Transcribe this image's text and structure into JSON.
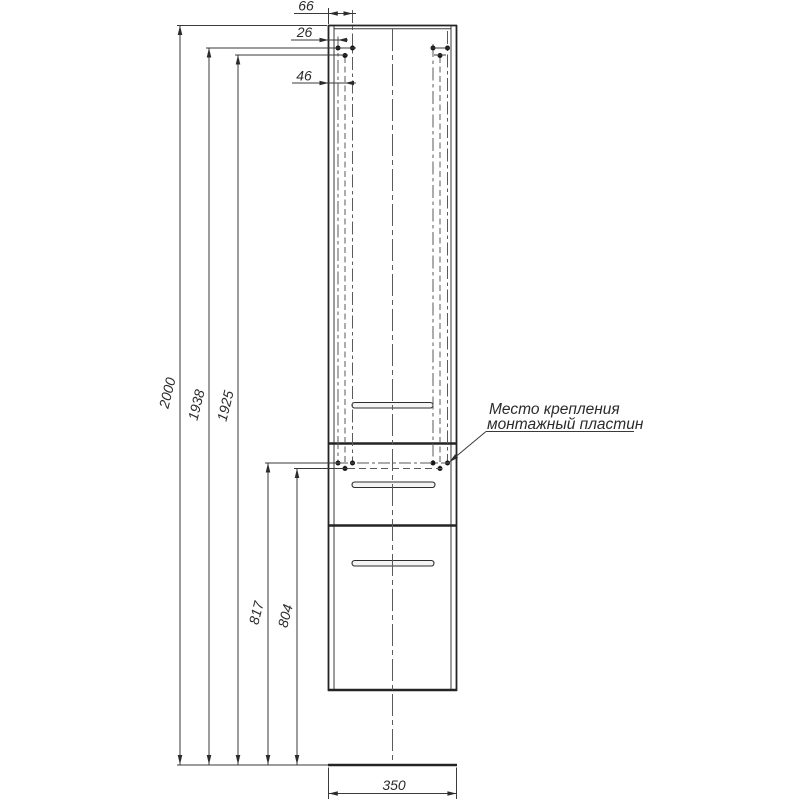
{
  "dimensions": {
    "top": [
      {
        "name": "hole-offset-outer",
        "label": "66"
      },
      {
        "name": "hole-offset-inner",
        "label": "26"
      },
      {
        "name": "hole-offset-middle",
        "label": "46"
      }
    ],
    "left": [
      {
        "name": "overall-height",
        "label": "2000"
      },
      {
        "name": "top-hole-outer-height",
        "label": "1938"
      },
      {
        "name": "top-hole-middle-height",
        "label": "1925"
      },
      {
        "name": "plate-hole-outer-height",
        "label": "817"
      },
      {
        "name": "plate-hole-middle-height",
        "label": "804"
      }
    ],
    "bottom": {
      "name": "overall-width",
      "label": "350"
    }
  },
  "annotation": {
    "line1": "Место крепления",
    "line2": "монтажный пластин"
  },
  "colors": {
    "line": "#242424",
    "centerline": "#5a5a5a",
    "text": "#2b2b2b",
    "background": "#ffffff"
  }
}
